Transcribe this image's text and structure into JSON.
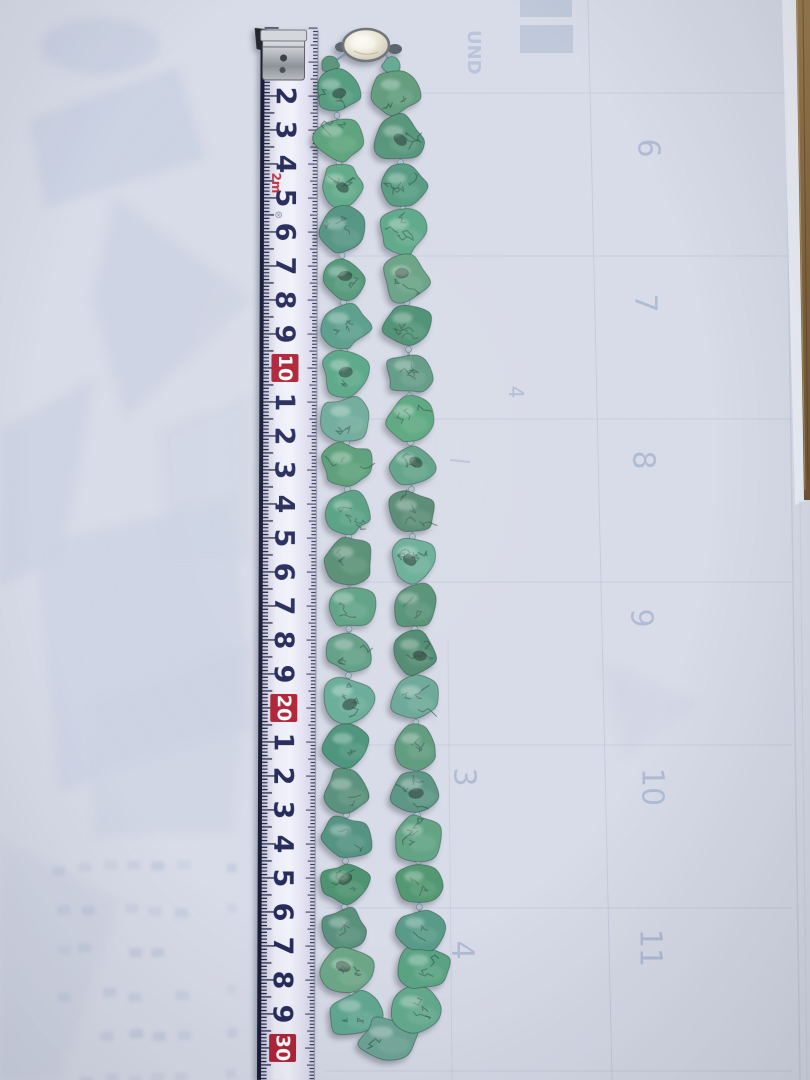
{
  "scene": {
    "description": "Photograph of a turquoise nugget bead necklace laid out vertically on translucent paper over a faint calendar page, with a tape measure on the left showing the necklace is about 30 cm long (doubled)",
    "background_color": "#d8dce8",
    "wood_edge_color": "#8a6d42"
  },
  "tape_measure": {
    "marks": [
      {
        "label": "2",
        "red": false
      },
      {
        "label": "3",
        "red": false
      },
      {
        "label": "4",
        "red": false
      },
      {
        "label": "5",
        "red": false
      },
      {
        "label": "6",
        "red": false
      },
      {
        "label": "7",
        "red": false
      },
      {
        "label": "8",
        "red": false
      },
      {
        "label": "9",
        "red": false
      },
      {
        "label": "10",
        "red": true
      },
      {
        "label": "1",
        "red": false
      },
      {
        "label": "2",
        "red": false
      },
      {
        "label": "3",
        "red": false
      },
      {
        "label": "4",
        "red": false
      },
      {
        "label": "5",
        "red": false
      },
      {
        "label": "6",
        "red": false
      },
      {
        "label": "7",
        "red": false
      },
      {
        "label": "8",
        "red": false
      },
      {
        "label": "9",
        "red": false
      },
      {
        "label": "20",
        "red": true
      },
      {
        "label": "1",
        "red": false
      },
      {
        "label": "2",
        "red": false
      },
      {
        "label": "3",
        "red": false
      },
      {
        "label": "4",
        "red": false
      },
      {
        "label": "5",
        "red": false
      },
      {
        "label": "6",
        "red": false
      },
      {
        "label": "7",
        "red": false
      },
      {
        "label": "8",
        "red": false
      },
      {
        "label": "9",
        "red": false
      },
      {
        "label": "30",
        "red": true
      }
    ],
    "unit_marker": "2m",
    "stamp": "⊛",
    "body_color": "#ececf7",
    "tick_color": "#1c2140",
    "number_color": "#262b5b",
    "highlight_box_color": "#b02437",
    "highlight_text_color": "#ffffff",
    "edge_color": "#191c38"
  },
  "necklace": {
    "clasp": {
      "type": "silver-oval-box-clasp",
      "color": "#e8e4d6",
      "ring_color": "#70757c",
      "cx": 366,
      "cy": 45,
      "rx": 23,
      "ry": 16
    },
    "bead_base_color": "#64a18b",
    "bead_vein_color": "#2c5246",
    "string_color": "#7e95a8",
    "spacer_color": "#aebfca",
    "top_connectors": [
      [
        330,
        64,
        18,
        16
      ],
      [
        391,
        66,
        18,
        16
      ]
    ],
    "left_strand": [
      [
        336,
        92,
        44,
        42
      ],
      [
        338,
        139,
        48,
        44
      ],
      [
        340,
        186,
        42,
        40
      ],
      [
        341,
        232,
        48,
        46
      ],
      [
        343,
        279,
        44,
        42
      ],
      [
        344,
        326,
        48,
        44
      ],
      [
        345,
        373,
        44,
        44
      ],
      [
        346,
        419,
        46,
        44
      ],
      [
        347,
        466,
        48,
        46
      ],
      [
        348,
        513,
        44,
        42
      ],
      [
        349,
        560,
        46,
        44
      ],
      [
        349,
        606,
        48,
        44
      ],
      [
        349,
        652,
        44,
        42
      ],
      [
        348,
        699,
        48,
        46
      ],
      [
        348,
        746,
        46,
        42
      ],
      [
        347,
        792,
        48,
        44
      ],
      [
        346,
        838,
        48,
        44
      ],
      [
        345,
        884,
        46,
        42
      ],
      [
        344,
        930,
        44,
        42
      ]
    ],
    "bottom_curve": [
      [
        348,
        972,
        48,
        44
      ],
      [
        356,
        1014,
        52,
        46
      ],
      [
        388,
        1040,
        54,
        44
      ],
      [
        417,
        1010,
        50,
        46
      ],
      [
        424,
        968,
        48,
        44
      ]
    ],
    "right_strand": [
      [
        396,
        92,
        44,
        42
      ],
      [
        399,
        139,
        46,
        44
      ],
      [
        402,
        186,
        44,
        42
      ],
      [
        404,
        232,
        46,
        44
      ],
      [
        406,
        279,
        44,
        44
      ],
      [
        408,
        326,
        46,
        44
      ],
      [
        409,
        373,
        44,
        42
      ],
      [
        410,
        419,
        46,
        46
      ],
      [
        411,
        466,
        44,
        42
      ],
      [
        412,
        513,
        48,
        44
      ],
      [
        413,
        560,
        44,
        44
      ],
      [
        414,
        606,
        46,
        44
      ],
      [
        415,
        652,
        44,
        42
      ],
      [
        416,
        699,
        46,
        44
      ],
      [
        416,
        746,
        44,
        42
      ],
      [
        417,
        792,
        48,
        44
      ],
      [
        418,
        838,
        46,
        44
      ],
      [
        419,
        884,
        44,
        42
      ],
      [
        420,
        930,
        44,
        42
      ]
    ]
  },
  "background": {
    "grid_color": "#b6c0d4",
    "shapes_color": "#c5cde0",
    "ghost_number_color": "#abb7d0",
    "calendar_numbers": [
      {
        "label": "6",
        "x": 648,
        "y": 148,
        "size": 30
      },
      {
        "label": "7",
        "x": 645,
        "y": 303,
        "size": 30
      },
      {
        "label": "8",
        "x": 643,
        "y": 460,
        "size": 30
      },
      {
        "label": "9",
        "x": 641,
        "y": 618,
        "size": 30
      },
      {
        "label": "10",
        "x": 652,
        "y": 787,
        "size": 30
      },
      {
        "label": "11",
        "x": 650,
        "y": 948,
        "size": 30
      },
      {
        "label": "3",
        "x": 464,
        "y": 777,
        "size": 30
      },
      {
        "label": "4",
        "x": 462,
        "y": 950,
        "size": 30
      },
      {
        "label": "4",
        "x": 516,
        "y": 392,
        "size": 20
      }
    ],
    "ghost_letters": [
      {
        "label": "ND",
        "x": 374,
        "y": 28,
        "size": 20
      },
      {
        "label": "UND",
        "x": 481,
        "y": 30,
        "size": 18
      }
    ]
  }
}
